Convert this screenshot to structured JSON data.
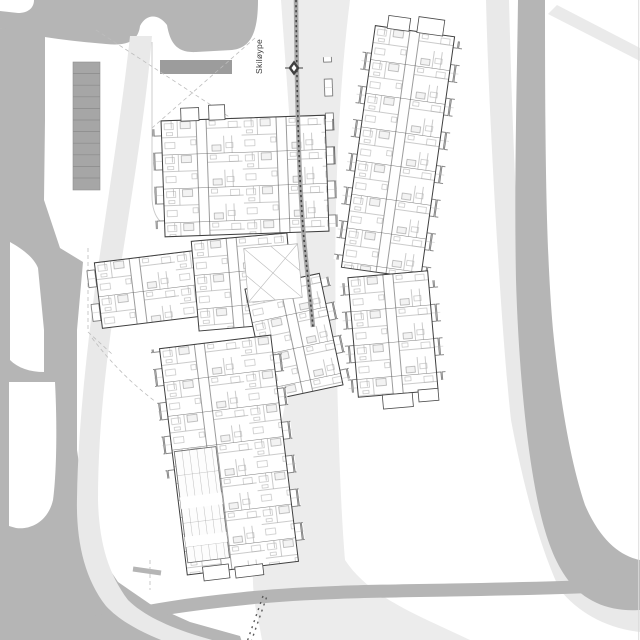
{
  "drawing": {
    "kind": "architectural site plan",
    "description": "Black-and-white site plan with two elongated apartment buildings, surrounding roads, pedestrian paths and a ski trail corridor"
  },
  "labels": {
    "ski_trail": "Skiløype"
  },
  "colors": {
    "background": "#ffffff",
    "road_gray": "#b5b5b5",
    "path_light_gray": "#e9e9e9",
    "parking_strip_gray": "#a6a6a6",
    "dark_area_gray": "#9c9c9c",
    "building_wall": "#3f3f3f",
    "ski_trail_dash": "#414141"
  }
}
